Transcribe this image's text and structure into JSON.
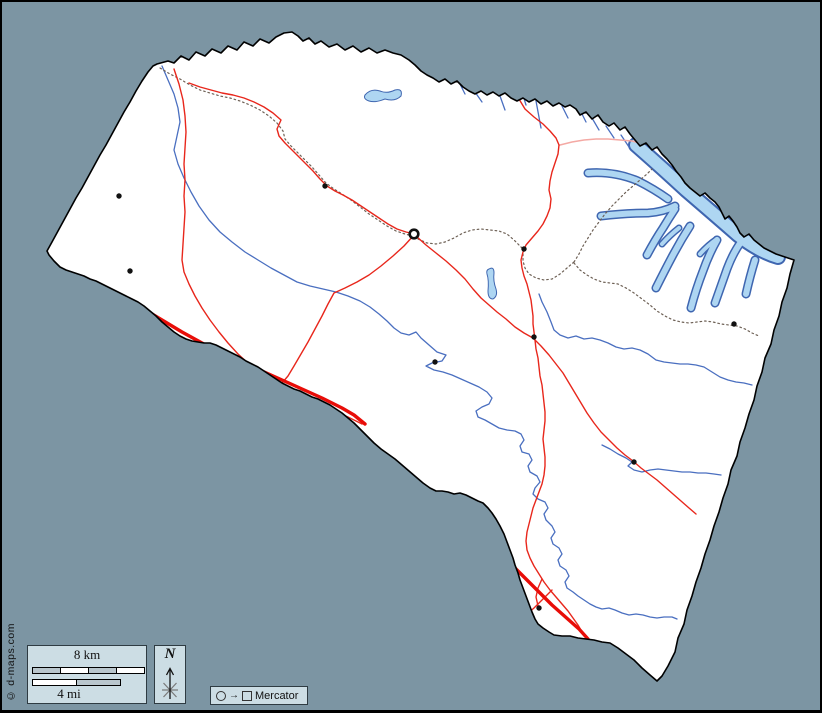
{
  "panels": {
    "scale": {
      "km_label": "8 km",
      "mi_label": "4 mi"
    },
    "north": {
      "label": "N"
    },
    "projection": {
      "arrow": "→",
      "label": "Mercator"
    }
  },
  "copyright": "© d-maps.com",
  "colors": {
    "bg": "#7C95A3",
    "panel": "#CCDDE4",
    "panel_border": "#2E3B42",
    "land": "#FFFFFF",
    "boundary": "#000000",
    "river": "#4A6FC0",
    "lake_fill": "#AED6F2",
    "lake_stroke": "#3F66B0",
    "road": "#E8271C",
    "highway": "#E80D08",
    "road_light": "#F4A9A4",
    "dotted": "#6E6156",
    "town": "#111111",
    "scale_gray": "#B9C6CD",
    "scale_white": "#FFFFFF",
    "frame": "#000000"
  }
}
